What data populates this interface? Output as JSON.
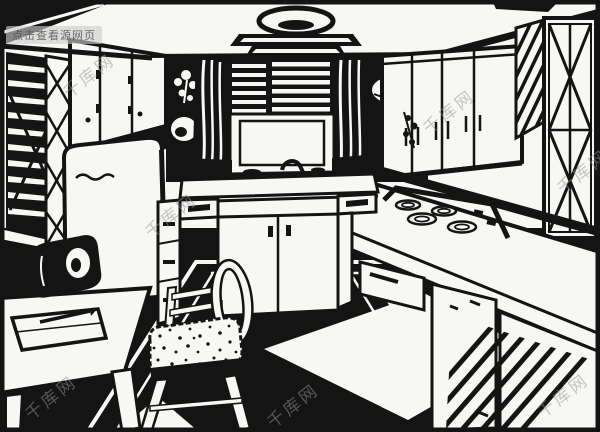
{
  "meta": {
    "alt": "Black-and-white vintage line-art illustration of a retro kitchen interior drawn in one-point perspective",
    "style": "ink clip art"
  },
  "palette": {
    "ink": "#141414",
    "paper": "#f7f7f4",
    "watermark_text": "rgba(148,148,148,0.52)",
    "watermark_badge_bg": "rgba(205,205,205,0.62)",
    "watermark_badge_text": "rgba(82,82,82,0.85)"
  },
  "watermarks": {
    "badge_label": "点击查看源网页",
    "site_name": "千库网"
  },
  "scene": {
    "objects": [
      "ceiling-lamp",
      "back-window-blinds",
      "window-curtains",
      "left-window-blinds",
      "left-upper-cabinets",
      "right-upper-cabinets",
      "corner-lattice-cabinet",
      "refrigerator",
      "sink-counter",
      "faucet",
      "base-cabinets",
      "cooktop-burners",
      "right-counter-cabinets",
      "desk",
      "telephone",
      "notepad-and-pencil",
      "chair-with-fur-seat",
      "area-rug",
      "floor-diamond",
      "potted-plant",
      "kettle",
      "bowl"
    ]
  }
}
